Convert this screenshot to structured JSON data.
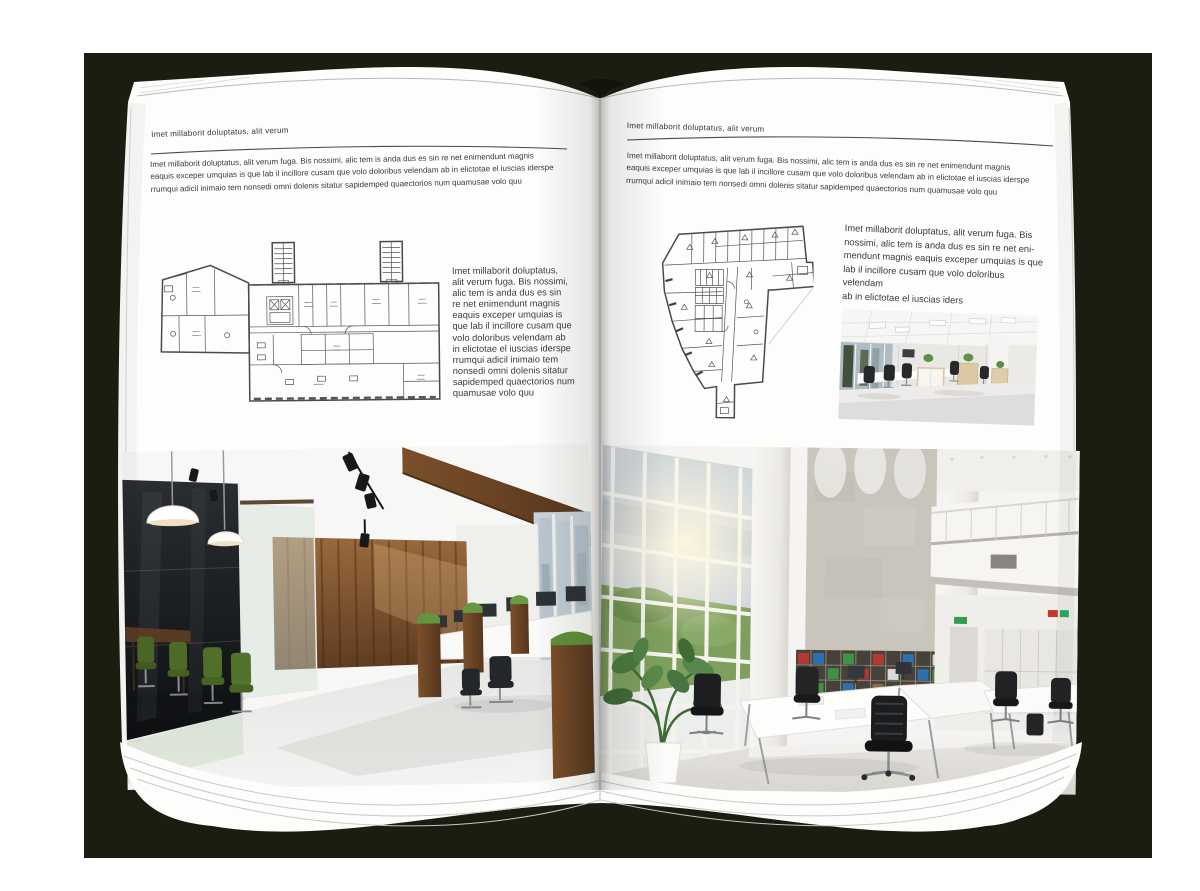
{
  "colors": {
    "book_background": "#1a1d0f",
    "page": "#fdfdfc",
    "text": "#3a3a3a",
    "rule": "#4a4a4a"
  },
  "left_page": {
    "header": "Imet millaborit doluptatus, alit verum",
    "intro": "Imet millaborit doluptatus, alit verum fuga. Bis nossimi, alic tem is anda dus es sin re net enimendunt magnis\neaquis exceper umquias is que lab il incillore cusam que volo doloribus velendam ab in elictotae el iuscias iderspe\nrrumqui adicil inimaio tem nonsedi omni dolenis sitatur sapidemped quaectorios num quamusae volo quu",
    "caption": "Imet millaborit doluptatus,\nalit verum fuga. Bis nossimi,\nalic tem is anda dus es sin\nre net enimendunt magnis\neaquis exceper umquias is\nque lab il incillore cusam que\nvolo doloribus velendam ab\nin elictotae el iuscias iderspe\nrrumqui adicil inimaio tem\nnonsedi omni dolenis sitatur\nsapidemped quaectorios num\nquamusae volo quu"
  },
  "right_page": {
    "header": "Imet millaborit doluptatus, alit verum",
    "intro": "Imet millaborit doluptatus, alit verum fuga. Bis nossimi, alic tem is anda dus es sin re net enimendunt magnis\neaquis exceper umquias is que lab il incillore cusam que volo doloribus velendam ab in elictotae el iuscias iderspe\nrrumqui adicil inimaio tem nonsedi omni dolenis sitatur sapidemped quaectorios num quamusae volo quu",
    "caption": "Imet millaborit doluptatus, alit verum fuga. Bis\nnossimi, alic tem is anda dus es sin re net eni-\nmendunt magnis eaquis exceper umquias is que\nlab il incillore cusam que volo doloribus velendam\nab in elictotae el iuscias iders"
  }
}
